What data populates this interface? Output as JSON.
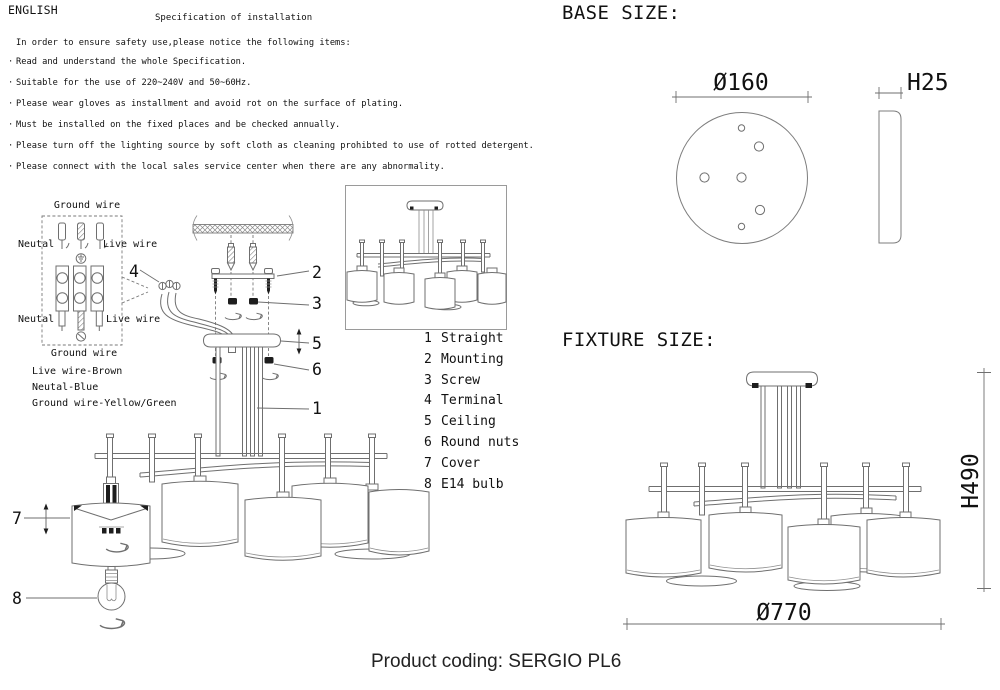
{
  "header": {
    "language": "ENGLISH",
    "title": "Specification of installation",
    "intro": "In order to ensure safety use,please notice the following items:",
    "bullet": "·",
    "safety_items": [
      "Read and understand the whole Specification.",
      "Suitable for the use of 220~240V and 50~60Hz.",
      "Please wear gloves as installment and avoid rot on the surface of plating.",
      "Must be installed on the fixed places and be checked annually.",
      "Please turn off the lighting source by soft cloth as cleaning prohibted to use of rotted detergent.",
      "Please connect with the local sales service center when there are any abnormality."
    ]
  },
  "wiring_diagram": {
    "ground_wire_top": "Ground wire",
    "neutral_top": "Neutal",
    "live_top": "Live wire",
    "neutral_bottom": "Neutal",
    "live_bottom": "Live wire",
    "ground_wire_bottom": "Ground wire",
    "legend": [
      "Live wire-Brown",
      "Neutal-Blue",
      "Ground wire-Yellow/Green"
    ]
  },
  "parts_list": [
    {
      "num": "1",
      "name": "Straight"
    },
    {
      "num": "2",
      "name": "Mounting"
    },
    {
      "num": "3",
      "name": "Screw"
    },
    {
      "num": "4",
      "name": "Terminal"
    },
    {
      "num": "5",
      "name": "Ceiling"
    },
    {
      "num": "6",
      "name": "Round nuts"
    },
    {
      "num": "7",
      "name": "Cover"
    },
    {
      "num": "8",
      "name": "E14 bulb"
    }
  ],
  "base_size": {
    "title": "BASE SIZE:",
    "diameter_label": "Ø160",
    "height_label": "H25"
  },
  "fixture_size": {
    "title": "FIXTURE SIZE:",
    "height_label": "H490",
    "diameter_label": "Ø770"
  },
  "footer": {
    "product_coding": "Product coding: SERGIO PL6"
  },
  "colors": {
    "line": "#6f6f6f",
    "text": "#111111",
    "background": "#ffffff"
  }
}
